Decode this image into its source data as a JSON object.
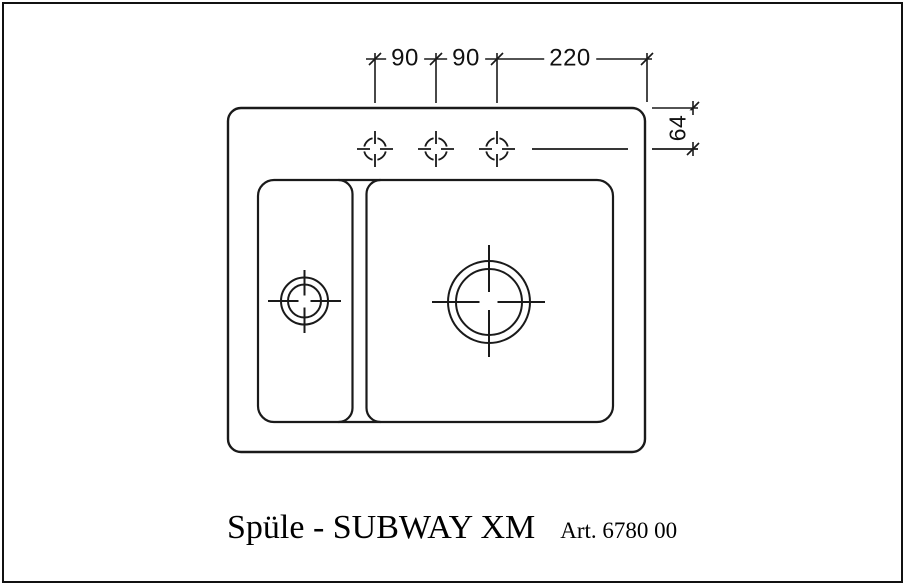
{
  "page": {
    "background": "#ffffff",
    "line_color": "#1a1a1a",
    "frame_color": "#111111"
  },
  "title_block": {
    "product_name": "Spüle - SUBWAY XM",
    "article_number": "Art. 6780 00"
  },
  "dimensions": {
    "tap_hole_spacing_1": "90",
    "tap_hole_spacing_2": "90",
    "tap_hole_spacing_3": "220",
    "rim_to_tap_center": "64"
  },
  "symbols": {
    "tap_holes": 3,
    "drains": 2
  }
}
